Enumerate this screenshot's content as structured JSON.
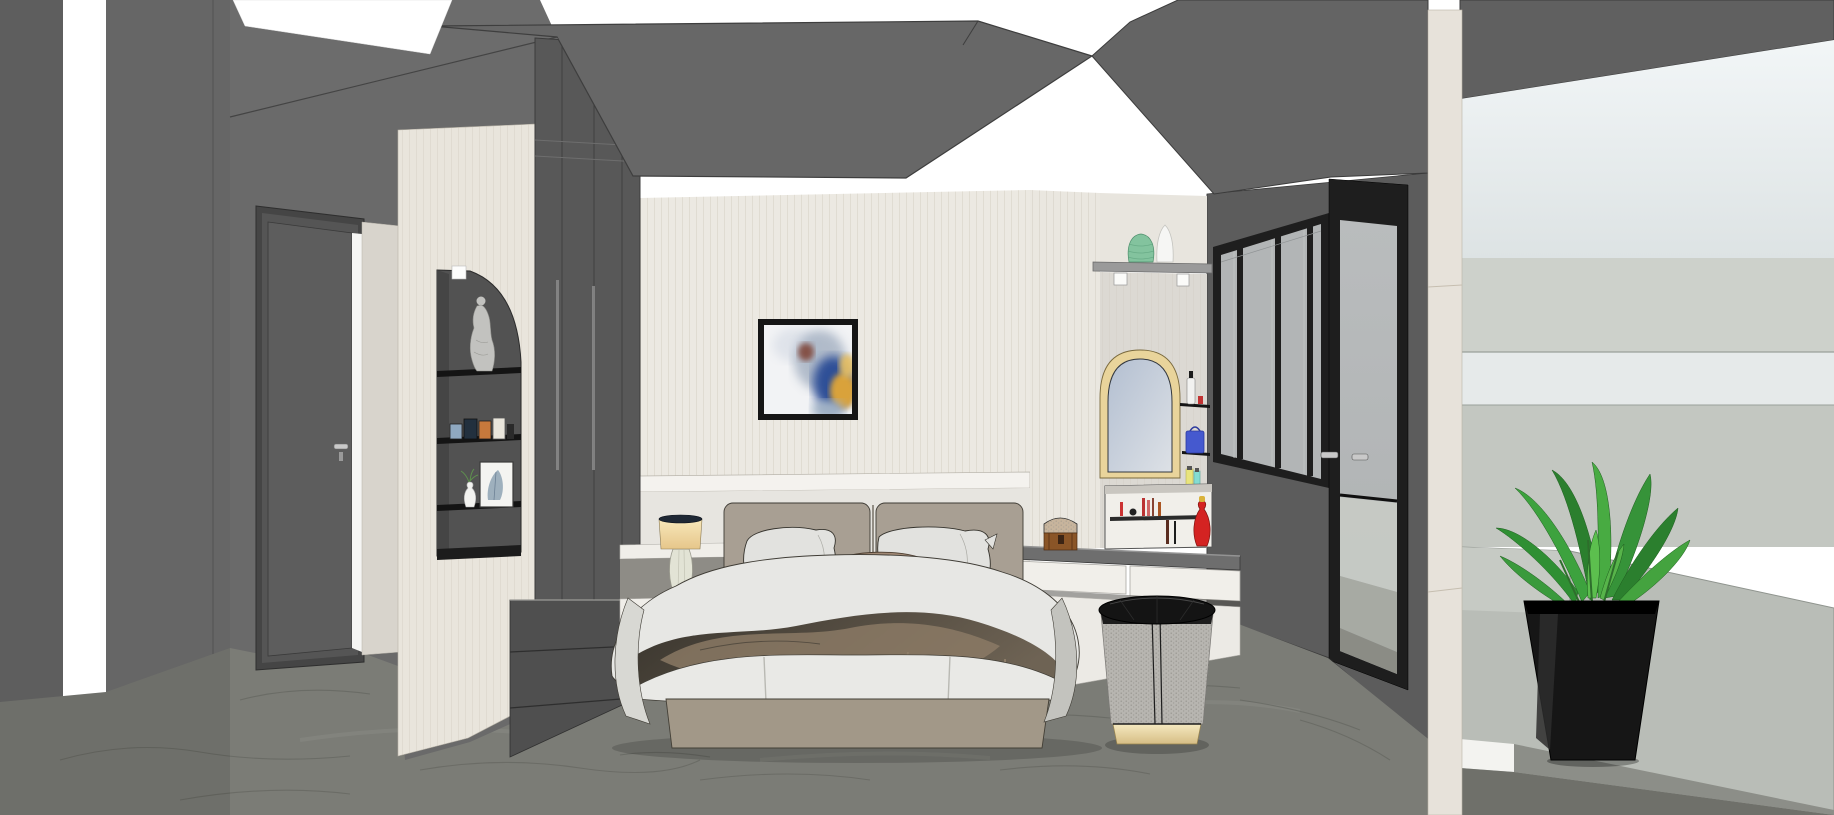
{
  "meta": {
    "title": "Bedroom interior 3D rendering",
    "style": "SketchUp-like architectural visualization",
    "view": "interior elevation toward bed wall with balcony on right",
    "canvas": {
      "width": 1834,
      "height": 815
    }
  },
  "colors": {
    "lightStrip": "#ffffff",
    "ceilingSlab": "#676767",
    "ceilingSoffit": "#646464",
    "wallEdge": "#5e5e5e",
    "wallLeftA": "#666666",
    "wallLeftB": "#6a6a6a",
    "wallLeftTop": "#6c6c6c",
    "doorFrame": "#454545",
    "doorLeaf": "#5d5d5d",
    "doorJamb": "#d8d4cc",
    "pillarCream": "#e9e5dc",
    "nicheBack": "#525252",
    "shelfBlack": "#141414",
    "statue": "#c2c2bf",
    "wardrobe": "#585858",
    "wallCreamUpper": "#ece9e2",
    "wallMolding": "#f4f2ee",
    "wallCreamLower": "#e7e5e0",
    "artFrame": "#161616",
    "artBlue": "#2f4f97",
    "artGold": "#d9a23b",
    "vanityColumn": "#eae7e0",
    "vanityWall": "#dcd9d3",
    "displayShelf": "#9a9a9a",
    "vaseGreen": "#83c39e",
    "vaseWhite": "#f6f6f4",
    "mirrorFrame": "#e9d49b",
    "mirrorGlass": "#b7c2d2",
    "deskTop": "#6e6e6e",
    "drawerWhite": "#f1efea",
    "chestBody": "#8a5527",
    "chestLid": "#c7b49c",
    "redVase": "#d42322",
    "bagBlue": "#4559cf",
    "bottleYellow": "#e9e47d",
    "bottleTeal": "#84dcd2",
    "windowFrame": "#1e1e1e",
    "windowGlass": "#b2b5b6",
    "windowWall": "#5c5c5c",
    "balconyColumn": "#e7e2da",
    "balconySoffit": "#606060",
    "skyTop": "#f2f6f7",
    "skyBottom": "#dde3e4",
    "balconyBand1": "#cdd1cb",
    "balconyBand2": "#e6eaea",
    "balconyBand3": "#c3c7c1",
    "parapet": "#b9bdb7",
    "balconyFloor": "#6f706a",
    "plantPot": "#161616",
    "leafDark": "#2b7f2e",
    "leafMid": "#3da23e",
    "leafLight": "#5cbf4e",
    "marbleFloor": "#7b7c76",
    "marbleVein": "#5e5f59",
    "bedFabric": "#a29888",
    "headboard": "#a89f93",
    "pillowWhite": "#e2e2df",
    "pillowBrown": "#a08874",
    "duvet": "#e7e7e4",
    "throwDark": "#453f36",
    "throwBrown": "#8d7c66",
    "lampShade": "#f2d9a8",
    "lampBase": "#e2e3d5",
    "nightstand": "#f0eee9",
    "drawerCabinet": "#4f4f4f",
    "stoolBody": "#b7b5b0",
    "stoolTop": "#141414",
    "stoolBaseGold": "#ecdcae",
    "handleSilver": "#c9c9c9"
  },
  "scene": {
    "room": "master bedroom",
    "objects": [
      {
        "name": "ceiling-light-channels",
        "description": "recessed white LED strips around dark gray ceiling slab"
      },
      {
        "name": "interior-door",
        "description": "dark gray door on left wall with silver handle, light glowing at gap"
      },
      {
        "name": "display-niche",
        "description": "arched niche in cream pillar with Venus statue, photo frames, botanical print and bud vase on black shelves"
      },
      {
        "name": "wardrobe",
        "description": "dark gray floor-to-ceiling wardrobe panels"
      },
      {
        "name": "accent-wall",
        "description": "cream paneled headboard wall with molding band"
      },
      {
        "name": "abstract-painting",
        "description": "black framed abstract art in white, blue and gold"
      },
      {
        "name": "bed",
        "description": "upholstered taupe bed with white pillows, brown accent pillow, white duvet and fringed brown throw"
      },
      {
        "name": "table-lamp",
        "description": "cream drum shade lamp with glass base on floating nightstand"
      },
      {
        "name": "drawer-cabinet",
        "description": "low dark gray drawer unit beside bed"
      },
      {
        "name": "display-shelf",
        "description": "shelf with green vase and white vase above vanity"
      },
      {
        "name": "arched-mirror",
        "description": "gold framed arched vanity mirror"
      },
      {
        "name": "cosmetic-shelves",
        "description": "corner shelves with spray bottle, blue bag and toiletry bottles"
      },
      {
        "name": "makeup-niche",
        "description": "white niche over desk with lipsticks, brushes and red vase"
      },
      {
        "name": "jewelry-chest",
        "description": "small brown treasure chest on floating vanity desk"
      },
      {
        "name": "vanity-desk",
        "description": "floating white vanity desk with gray top and two drawers"
      },
      {
        "name": "vanity-stool",
        "description": "round stool with black cushion, woven gray body and gold base"
      },
      {
        "name": "window-wall",
        "description": "black aluminium framed sliding windows and glass door to balcony"
      },
      {
        "name": "balcony",
        "description": "bright balcony with parapet, sky and potted green plant in black planter"
      },
      {
        "name": "marble-floor",
        "description": "gray marble floor with subtle veining"
      }
    ]
  }
}
